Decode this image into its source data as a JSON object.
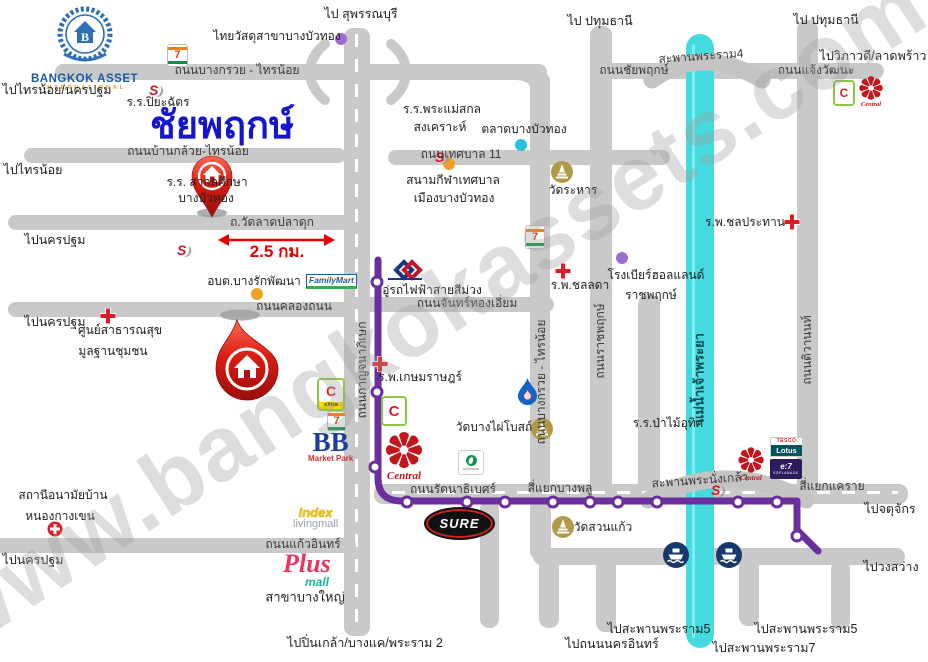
{
  "watermark": "www.bangkokassets.com",
  "title": "ชัยพฤกษ์",
  "brand": {
    "line1": "BANGKOK ASSET",
    "line2": "INTERNATIONAL"
  },
  "colors": {
    "road": "#c9c9c9",
    "river": "#45dade",
    "mrt_line": "#6b2e9e",
    "title_blue": "#1515cf",
    "distance_red": "#e60000"
  },
  "logos": {
    "seven": "7",
    "s_school": "S",
    "familymart": "FamilyMart",
    "bigc": "C",
    "bigc_extra": "eXtra",
    "central": "Central",
    "tesco": "TESCO",
    "lotus": "Lotus",
    "esplanade_1": "e:7",
    "esplanade_2": "ESPLANADE",
    "tops_dot": "",
    "bb": "BB",
    "bb_sub": "Market Park",
    "index": "Index",
    "index_sub": "livingmall",
    "plus": "Plus",
    "plus_sub": "mall",
    "sure": "SURE"
  },
  "distance": {
    "value": "2.5 กม."
  },
  "labels": [
    {
      "n": "dir-suphanburi",
      "t": "ไป สุพรรณบุรี",
      "x": 361,
      "y": 14,
      "c": "d"
    },
    {
      "n": "poi-thaiwatsadu",
      "t": "ไทยวัสดุสาขาบางบัวทอง",
      "x": 277,
      "y": 37,
      "c": "p"
    },
    {
      "n": "dir-pathumthani-1",
      "t": "ไป ปทุมธานี",
      "x": 600,
      "y": 21,
      "c": "d"
    },
    {
      "n": "dir-pathumthani-2",
      "t": "ไป ปทุมธานี",
      "x": 826,
      "y": 20,
      "c": "d"
    },
    {
      "n": "dir-vibhavadi",
      "t": "ไปวิภาวดี/ลาดพร้าว",
      "x": 873,
      "y": 56,
      "c": "d"
    },
    {
      "n": "road-chaengwattana",
      "t": "ถนนแจ้งวัฒนะ",
      "x": 816,
      "y": 71,
      "c": "r"
    },
    {
      "n": "bridge-rama4-label",
      "t": "สะพานพระราม4",
      "x": 701,
      "y": 57,
      "c": "r",
      "rot": -4
    },
    {
      "n": "road-chaiyapruek",
      "t": "ถนนชัยพฤกษ์",
      "x": 634,
      "y": 71,
      "c": "r"
    },
    {
      "n": "road-bangkruai-sainoi-h",
      "t": "ถนนบางกรวย - ไทรน้อย",
      "x": 237,
      "y": 71,
      "c": "r"
    },
    {
      "n": "dir-sainoi-nakhonpathom",
      "t": "ไปไทรน้อย/นครปฐม",
      "x": 57,
      "y": 90,
      "c": "d"
    },
    {
      "n": "poi-piyachat-school",
      "t": "ร.ร.ปิยะฉัตร",
      "x": 158,
      "y": 103,
      "c": "p"
    },
    {
      "n": "project-title",
      "t": "ชัยพฤกษ์",
      "x": 222,
      "y": 127,
      "c": "t"
    },
    {
      "n": "poi-phramaesakol-1",
      "t": "ร.ร.พระแม่สกล",
      "x": 442,
      "y": 110,
      "c": "p"
    },
    {
      "n": "poi-phramaesakol-2",
      "t": "สงเคราะห์",
      "x": 440,
      "y": 128,
      "c": "p"
    },
    {
      "n": "poi-talad-bangbuathong",
      "t": "ตลาดบางบัวทอง",
      "x": 524,
      "y": 130,
      "c": "p"
    },
    {
      "n": "road-tesaban11",
      "t": "ถนนเทศบาล 11",
      "x": 461,
      "y": 155,
      "c": "r"
    },
    {
      "n": "road-bankluai-sainoi",
      "t": "ถนนบ้านกล้วย-ไทรน้อย",
      "x": 188,
      "y": 152,
      "c": "r"
    },
    {
      "n": "dir-sainoi",
      "t": "ไปไทรน้อย",
      "x": 33,
      "y": 170,
      "c": "d"
    },
    {
      "n": "poi-stadium-1",
      "t": "สนามกีฬาเทศบาล",
      "x": 453,
      "y": 181,
      "c": "p"
    },
    {
      "n": "poi-stadium-2",
      "t": "เมืองบางบัวทอง",
      "x": 454,
      "y": 199,
      "c": "p"
    },
    {
      "n": "poi-wat-rahan",
      "t": "วัดระหาร",
      "x": 573,
      "y": 191,
      "c": "p"
    },
    {
      "n": "poi-sakolsuksa-1",
      "t": "ร.ร. สากลศึกษา",
      "x": 207,
      "y": 183,
      "c": "p"
    },
    {
      "n": "poi-sakolsuksa-2",
      "t": "บางบัวทอง",
      "x": 206,
      "y": 199,
      "c": "p"
    },
    {
      "n": "poi-chonprathan-hospital",
      "t": "ร.พ.ชลประทาน",
      "x": 745,
      "y": 223,
      "c": "p"
    },
    {
      "n": "road-wat-ladpladuk",
      "t": "ถ.วัดลาดปลาดุก",
      "x": 272,
      "y": 223,
      "c": "r"
    },
    {
      "n": "dir-nakhonpathom-1",
      "t": "ไปนครปฐม",
      "x": 55,
      "y": 240,
      "c": "d"
    },
    {
      "n": "distance-label",
      "t": "2.5 กม.",
      "x": 277,
      "y": 252,
      "c": "dist"
    },
    {
      "n": "poi-obt-bangrak",
      "t": "อบต.บางรักพัฒนา",
      "x": 254,
      "y": 282,
      "c": "p"
    },
    {
      "n": "poi-beer-holland-1",
      "t": "โรงเบียร์ฮอลแลนด์",
      "x": 656,
      "y": 276,
      "c": "p"
    },
    {
      "n": "poi-beer-holland-2",
      "t": "ราชพฤกษ์",
      "x": 651,
      "y": 296,
      "c": "p"
    },
    {
      "n": "poi-mrt-depot",
      "t": "อู่รถไฟฟ้าสายสีม่วง",
      "x": 432,
      "y": 291,
      "c": "p"
    },
    {
      "n": "road-chanthong-iam",
      "t": "ถนนจันทร์ทองเอี่ยม",
      "x": 467,
      "y": 304,
      "c": "r"
    },
    {
      "n": "road-klongthanon",
      "t": "ถนนคลองถนน",
      "x": 294,
      "y": 307,
      "c": "r"
    },
    {
      "n": "dir-nakhonpathom-2",
      "t": "ไปนครปฐม",
      "x": 55,
      "y": 322,
      "c": "d"
    },
    {
      "n": "poi-health-center-1",
      "t": "ศูนย์สาธารณสุข",
      "x": 120,
      "y": 331,
      "c": "p"
    },
    {
      "n": "poi-health-center-2",
      "t": "มูลฐานชุมชน",
      "x": 113,
      "y": 352,
      "c": "p"
    },
    {
      "n": "poi-chonlada-hospital",
      "t": "ร.พ.ชลลดา",
      "x": 580,
      "y": 286,
      "c": "p"
    },
    {
      "n": "poi-kasemrad-hospital",
      "t": "ร.พ.เกษมราษฎร์",
      "x": 420,
      "y": 378,
      "c": "p"
    },
    {
      "n": "poi-wat-bangphai",
      "t": "วัดบางไผ่โบสถ์",
      "x": 494,
      "y": 428,
      "c": "p"
    },
    {
      "n": "poi-pamai-uthit-school",
      "t": "ร.ร.ป่าไม้อุทิศ",
      "x": 668,
      "y": 424,
      "c": "p"
    },
    {
      "n": "road-kanchanaphisek-v",
      "t": "ถนนกาญจนาภิเษก",
      "x": 363,
      "y": 370,
      "c": "rv"
    },
    {
      "n": "road-bangkruai-sainoi-v",
      "t": "ถนนบางกรวย - ไทรน้อย",
      "x": 542,
      "y": 382,
      "c": "rv"
    },
    {
      "n": "road-ratchapruek-v",
      "t": "ถนนราชพฤกษ์",
      "x": 601,
      "y": 341,
      "c": "rv"
    },
    {
      "n": "river-chaophraya",
      "t": "แม่น้ำเจ้าพระยา",
      "x": 700,
      "y": 378,
      "c": "riv"
    },
    {
      "n": "road-tiwanon-v",
      "t": "ถนนติวานนท์",
      "x": 808,
      "y": 350,
      "c": "rv"
    },
    {
      "n": "road-rattanathibet",
      "t": "ถนนรัตนาธิเบศร์",
      "x": 453,
      "y": 490,
      "c": "r"
    },
    {
      "n": "junction-bangplu",
      "t": "สี่แยกบางพลู",
      "x": 560,
      "y": 489,
      "c": "r"
    },
    {
      "n": "bridge-nangklao-label",
      "t": "สะพานพระนั่งเกล้า",
      "x": 700,
      "y": 481,
      "c": "r",
      "rot": -4
    },
    {
      "n": "junction-khae-rai",
      "t": "สี่แยกแคราย",
      "x": 832,
      "y": 487,
      "c": "r"
    },
    {
      "n": "dir-chatuchak",
      "t": "ไปจตุจักร",
      "x": 890,
      "y": 509,
      "c": "d"
    },
    {
      "n": "poi-wat-suankaew",
      "t": "วัดสวนแก้ว",
      "x": 603,
      "y": 528,
      "c": "p"
    },
    {
      "n": "dir-wongsawang",
      "t": "ไปวงสว่าง",
      "x": 891,
      "y": 567,
      "c": "d"
    },
    {
      "n": "poi-anamai-1",
      "t": "สถานีอนามัยบ้าน",
      "x": 63,
      "y": 496,
      "c": "p"
    },
    {
      "n": "poi-anamai-2",
      "t": "หนองกางเขน",
      "x": 60,
      "y": 517,
      "c": "p"
    },
    {
      "n": "road-kaew-in",
      "t": "ถนนแก้วอินทร์",
      "x": 303,
      "y": 545,
      "c": "r"
    },
    {
      "n": "poi-plus-branch",
      "t": "สาขาบางใหญ่",
      "x": 305,
      "y": 598,
      "c": "p",
      "fs": 13
    },
    {
      "n": "dir-nakhonpathom-3",
      "t": "ไปนครปฐม",
      "x": 33,
      "y": 560,
      "c": "d"
    },
    {
      "n": "dir-pinklao",
      "t": "ไปปิ่นเกล้า/บางแค/พระราม 2",
      "x": 365,
      "y": 643,
      "c": "d"
    },
    {
      "n": "dir-nakhon-in",
      "t": "ไปถนนนครอินทร์",
      "x": 612,
      "y": 644,
      "c": "d"
    },
    {
      "n": "dir-rama5-1",
      "t": "ไปสะพานพระราม5",
      "x": 659,
      "y": 629,
      "c": "d"
    },
    {
      "n": "dir-rama5-2",
      "t": "ไปสะพานพระราม5",
      "x": 806,
      "y": 629,
      "c": "d"
    },
    {
      "n": "dir-rama7",
      "t": "ไปสะพานพระราม7",
      "x": 764,
      "y": 648,
      "c": "d"
    }
  ],
  "dots": [
    {
      "n": "dot-thaiwatsadu",
      "x": 341,
      "y": 39,
      "color": "#9e6bd0"
    },
    {
      "n": "dot-talad-bangbuathong",
      "x": 521,
      "y": 145,
      "color": "#25c3e0"
    },
    {
      "n": "dot-stadium",
      "x": 449,
      "y": 164,
      "color": "#f0a125"
    },
    {
      "n": "dot-obt-bangrak",
      "x": 257,
      "y": 294,
      "color": "#f0a125"
    },
    {
      "n": "dot-beer-holland",
      "x": 622,
      "y": 258,
      "color": "#9e6bd0"
    }
  ],
  "transit": {
    "line_name": "MRT purple line",
    "stations": [
      [
        377,
        282
      ],
      [
        377,
        392
      ],
      [
        375,
        467
      ],
      [
        407,
        502
      ],
      [
        467,
        502
      ],
      [
        505,
        502
      ],
      [
        553,
        502
      ],
      [
        590,
        502
      ],
      [
        618,
        502
      ],
      [
        657,
        502
      ],
      [
        738,
        502
      ],
      [
        777,
        502
      ],
      [
        797,
        536
      ]
    ]
  }
}
